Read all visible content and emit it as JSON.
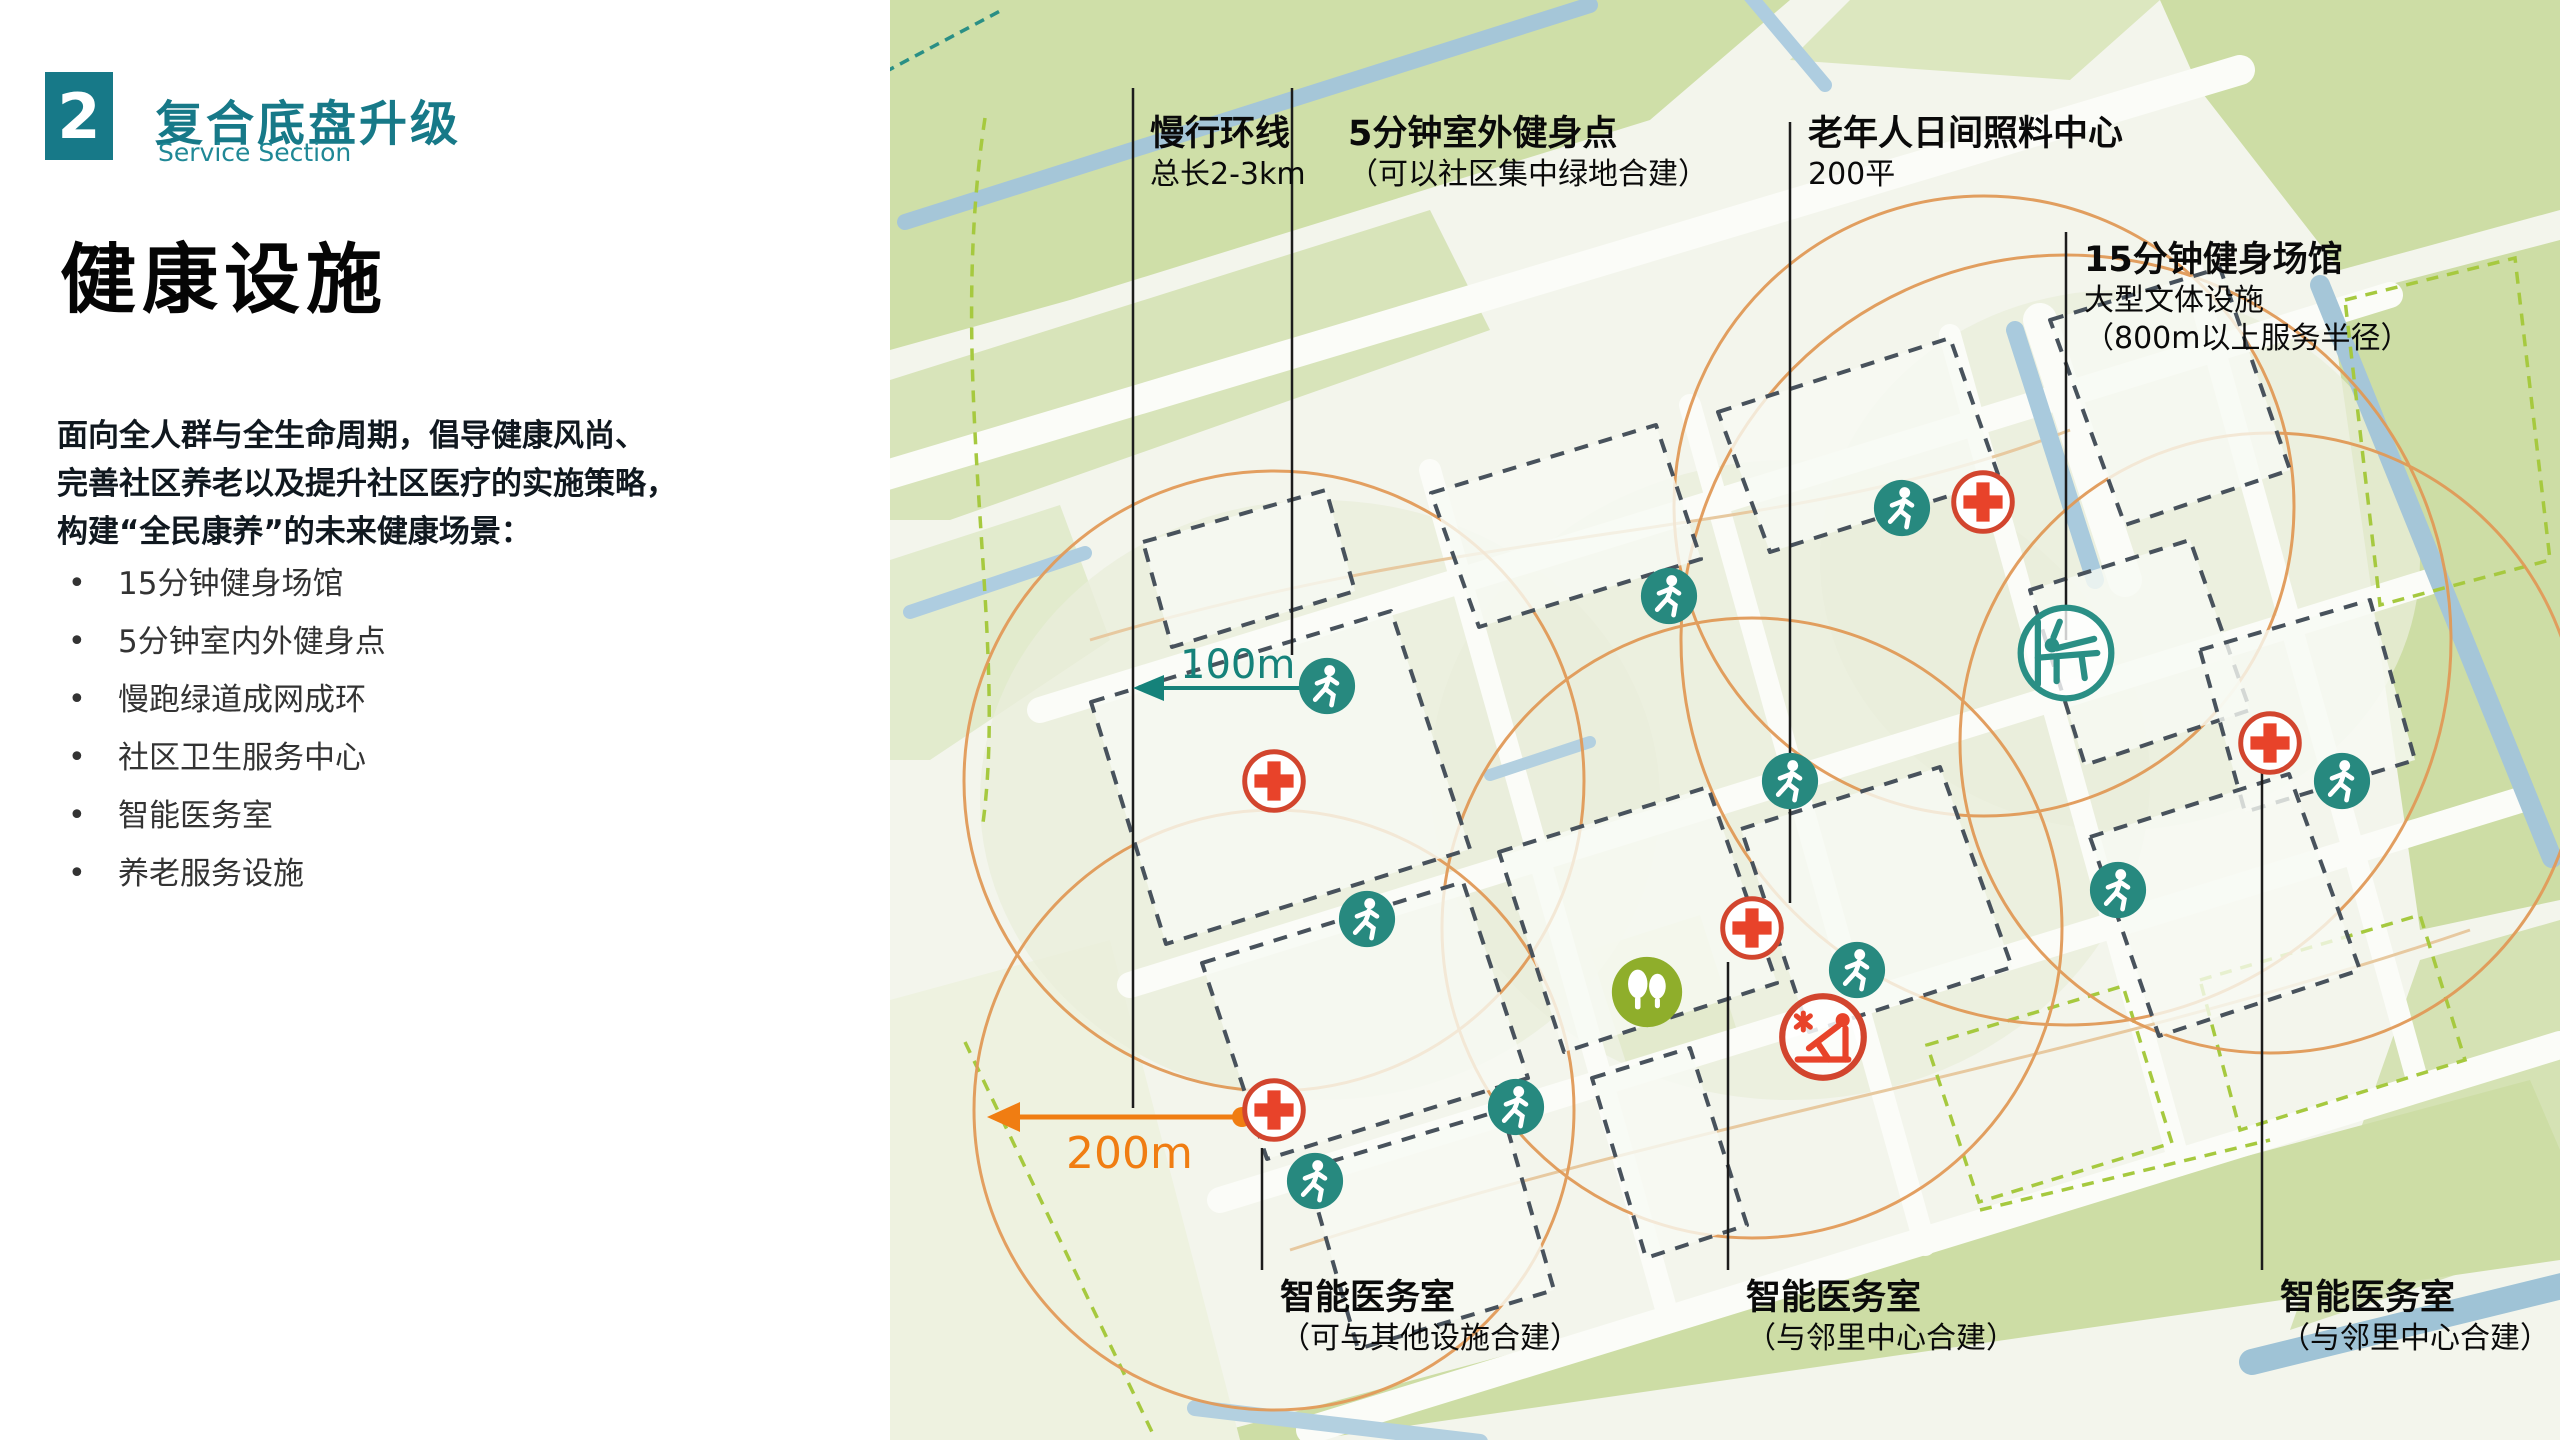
{
  "header": {
    "number": "2",
    "title": "复合底盘升级",
    "subtitle": "Service Section",
    "accent_color": "#177988"
  },
  "section": {
    "title": "健康设施",
    "paragraph_lines": [
      "面向全人群与全生命周期，倡导健康风尚、",
      "完善社区养老以及提升社区医疗的实施策略，",
      "构建“全民康养”的未来健康场景："
    ],
    "bullets": [
      "15分钟健身场馆",
      "5分钟室内外健身点",
      "慢跑绿道成网成环",
      "社区卫生服务中心",
      "智能医务室",
      "养老服务设施"
    ]
  },
  "map": {
    "labels": {
      "slow_loop": {
        "title": "慢行环线",
        "sub": "总长2-3km"
      },
      "outdoor_fitness": {
        "title": "5分钟室外健身点",
        "sub": "（可以社区集中绿地合建）"
      },
      "elder_daycare": {
        "title": "老年人日间照料中心",
        "sub": "200平"
      },
      "gym_15min": {
        "title": "15分钟健身场馆",
        "sub1": "大型文体设施",
        "sub2": "（800m以上服务半径）"
      },
      "clinic_left": {
        "title": "智能医务室",
        "sub": "（可与其他设施合建）"
      },
      "clinic_mid": {
        "title": "智能医务室",
        "sub": "（与邻里中心合建）"
      },
      "clinic_right": {
        "title": "智能医务室",
        "sub": "（与邻里中心合建）"
      }
    },
    "measures": {
      "walk_100m": "100m",
      "walk_200m": "200m"
    },
    "colors": {
      "accent_teal": "#177988",
      "measure_teal": "#15827a",
      "measure_orange": "#f07d12",
      "radius_circle": "#e19a58",
      "icon_teal": "#27897f",
      "icon_red": "#e8432a",
      "park_green": "#8fae2b"
    },
    "markers": [
      {
        "icon": "running-icon",
        "type": "running",
        "x": 1327,
        "y": 686
      },
      {
        "icon": "running-icon",
        "type": "running",
        "x": 1367,
        "y": 919
      },
      {
        "icon": "running-icon",
        "type": "running",
        "x": 1315,
        "y": 1181
      },
      {
        "icon": "running-icon",
        "type": "running",
        "x": 1516,
        "y": 1107
      },
      {
        "icon": "running-icon",
        "type": "running",
        "x": 1669,
        "y": 596
      },
      {
        "icon": "running-icon",
        "type": "running",
        "x": 1790,
        "y": 781
      },
      {
        "icon": "running-icon",
        "type": "running",
        "x": 1857,
        "y": 970
      },
      {
        "icon": "running-icon",
        "type": "running",
        "x": 1902,
        "y": 508
      },
      {
        "icon": "running-icon",
        "type": "running",
        "x": 2118,
        "y": 890
      },
      {
        "icon": "running-icon",
        "type": "running",
        "x": 2342,
        "y": 781
      },
      {
        "icon": "clinic-cross-icon",
        "type": "clinic",
        "x": 1274,
        "y": 781
      },
      {
        "icon": "clinic-cross-icon",
        "type": "clinic",
        "x": 1274,
        "y": 1110
      },
      {
        "icon": "clinic-cross-icon",
        "type": "clinic",
        "x": 1752,
        "y": 928
      },
      {
        "icon": "clinic-cross-icon",
        "type": "clinic",
        "x": 1983,
        "y": 502
      },
      {
        "icon": "clinic-cross-icon",
        "type": "clinic",
        "x": 2270,
        "y": 743
      },
      {
        "icon": "gym-icon",
        "type": "gym",
        "x": 2066,
        "y": 653
      },
      {
        "icon": "eldercare-icon",
        "type": "eldercare",
        "x": 1823,
        "y": 1037
      },
      {
        "icon": "park-icon",
        "type": "park",
        "x": 1647,
        "y": 992
      }
    ]
  }
}
